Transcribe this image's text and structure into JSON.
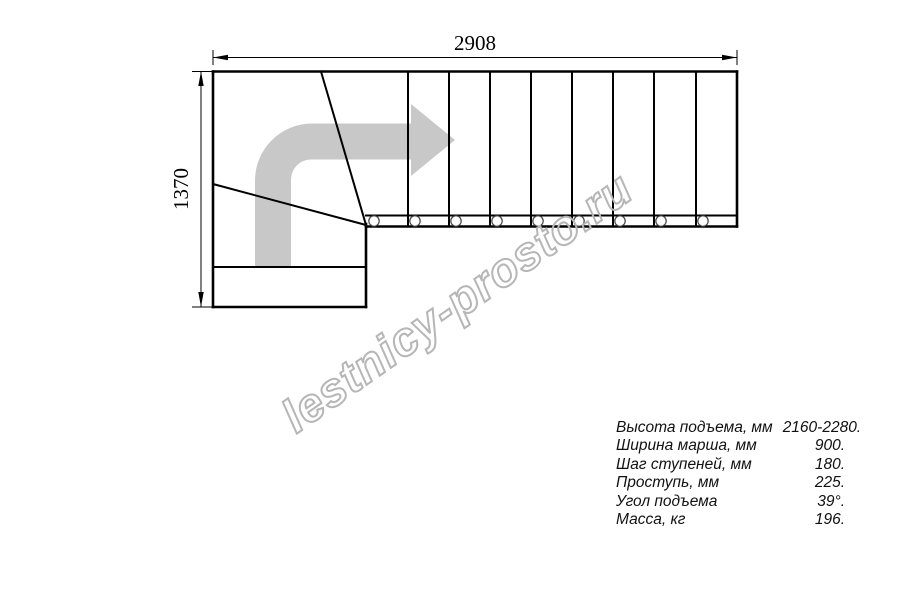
{
  "drawing": {
    "title": "L-shaped staircase plan (top view)",
    "width_dimension_label": "2908",
    "height_dimension_label": "1370",
    "straight_steps_count": 9,
    "colors": {
      "line": "#000000",
      "direction_arrow_fill": "#c8c8c8",
      "watermark_stroke": "#b6b6b6",
      "baluster_stroke": "#444444"
    }
  },
  "watermark": {
    "text": "lestnicy-prosto.ru"
  },
  "specs": {
    "rows": [
      {
        "label": "Высота подъема, мм",
        "value": "2160-2280."
      },
      {
        "label": "Ширина марша, мм",
        "value": "900."
      },
      {
        "label": "Шаг ступеней, мм",
        "value": "180."
      },
      {
        "label": "Проступь, мм",
        "value": "225."
      },
      {
        "label": "Угол подъема",
        "value": "39°."
      },
      {
        "label": "Масса, кг",
        "value": "196."
      }
    ]
  }
}
